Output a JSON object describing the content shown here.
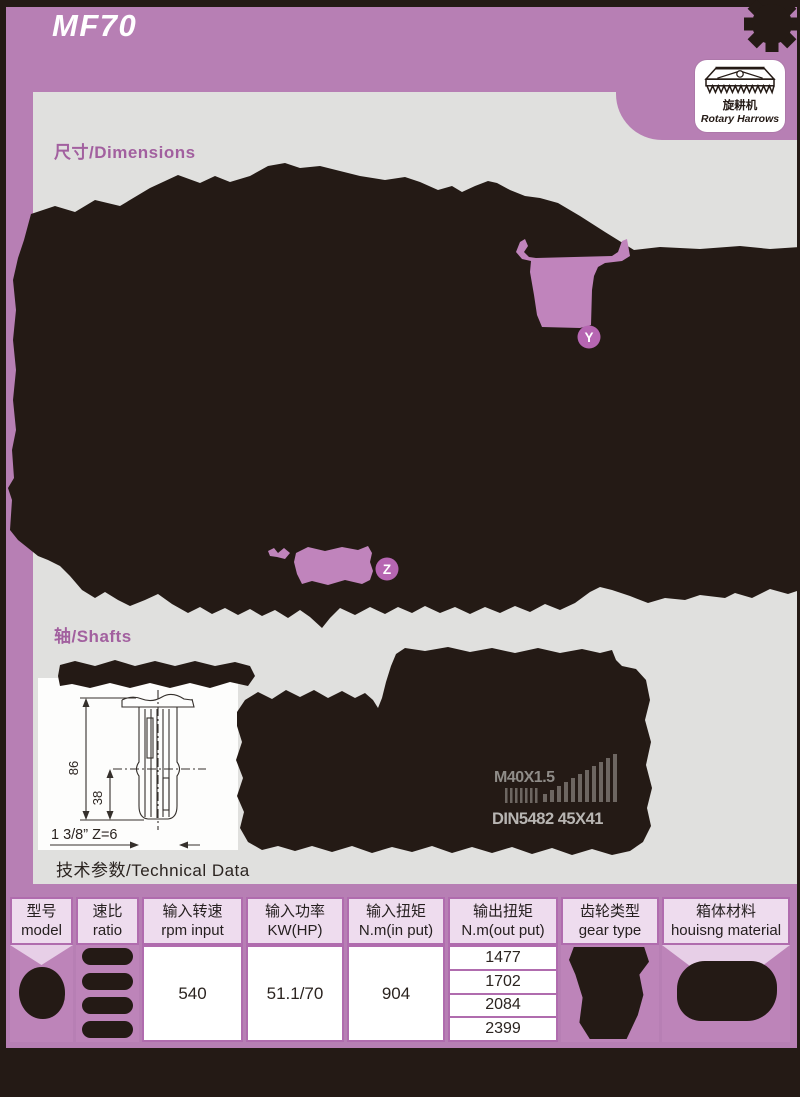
{
  "page": {
    "title": "MF70"
  },
  "badge": {
    "zh": "旋耕机",
    "en": "Rotary Harrows"
  },
  "sections": {
    "dimensions": {
      "label": "尺寸/Dimensions"
    },
    "shafts": {
      "label": "轴/Shafts",
      "thread_spec": "M40X1.5",
      "spline_spec": "DIN5482 45X41"
    },
    "technical": {
      "label": "技术参数/Technical Data"
    }
  },
  "shaft_drawing": {
    "dim_total": "86",
    "dim_spline": "38",
    "spline_label": "1 3/8” Z=6"
  },
  "callouts": {
    "y": "Y",
    "z": "Z"
  },
  "table": {
    "headers": [
      {
        "zh": "型号",
        "en": "model"
      },
      {
        "zh": "速比",
        "en": "ratio"
      },
      {
        "zh": "输入转速",
        "en": "rpm input"
      },
      {
        "zh": "输入功率",
        "en": "KW(HP)"
      },
      {
        "zh": "输入扭矩",
        "en": "N.m(in put)"
      },
      {
        "zh": "输出扭矩",
        "en": "N.m(out put)"
      },
      {
        "zh": "齿轮类型",
        "en": "gear type"
      },
      {
        "zh": "箱体材料",
        "en": "houisng material"
      }
    ],
    "values": {
      "rpm_input": "540",
      "input_power": "51.1/70",
      "input_torque": "904",
      "output_torque": [
        "1477",
        "1702",
        "2084",
        "2399"
      ]
    }
  },
  "colors": {
    "purple": "#b77fb4",
    "table_purple": "#bd84b9",
    "border_purple": "#b06cae",
    "lavender": "#eedcee",
    "panel_gray": "#e0e0de",
    "ink": "#241a15",
    "label_purple": "#a2609f",
    "highlight": "#c084bc"
  }
}
